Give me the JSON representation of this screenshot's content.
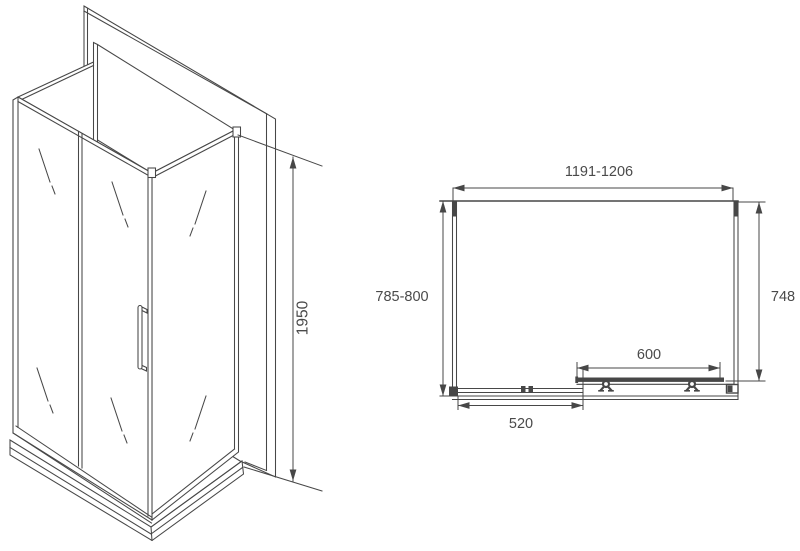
{
  "title": "Shower enclosure technical drawing",
  "views": {
    "isometric": {
      "description": "3D view of corner shower enclosure with sliding door, side glass panels, back wall panel and low tray",
      "height_label": "1950"
    },
    "plan": {
      "description": "Top (plan) view with overall and door dimensions",
      "width_label": "1191-1206",
      "depth_label": "785-800",
      "side_label": "748",
      "door_label": "600",
      "fixed_panel_label": "520"
    }
  },
  "colors": {
    "line": "#474747",
    "text": "#4a4a4a",
    "background": "#ffffff"
  }
}
